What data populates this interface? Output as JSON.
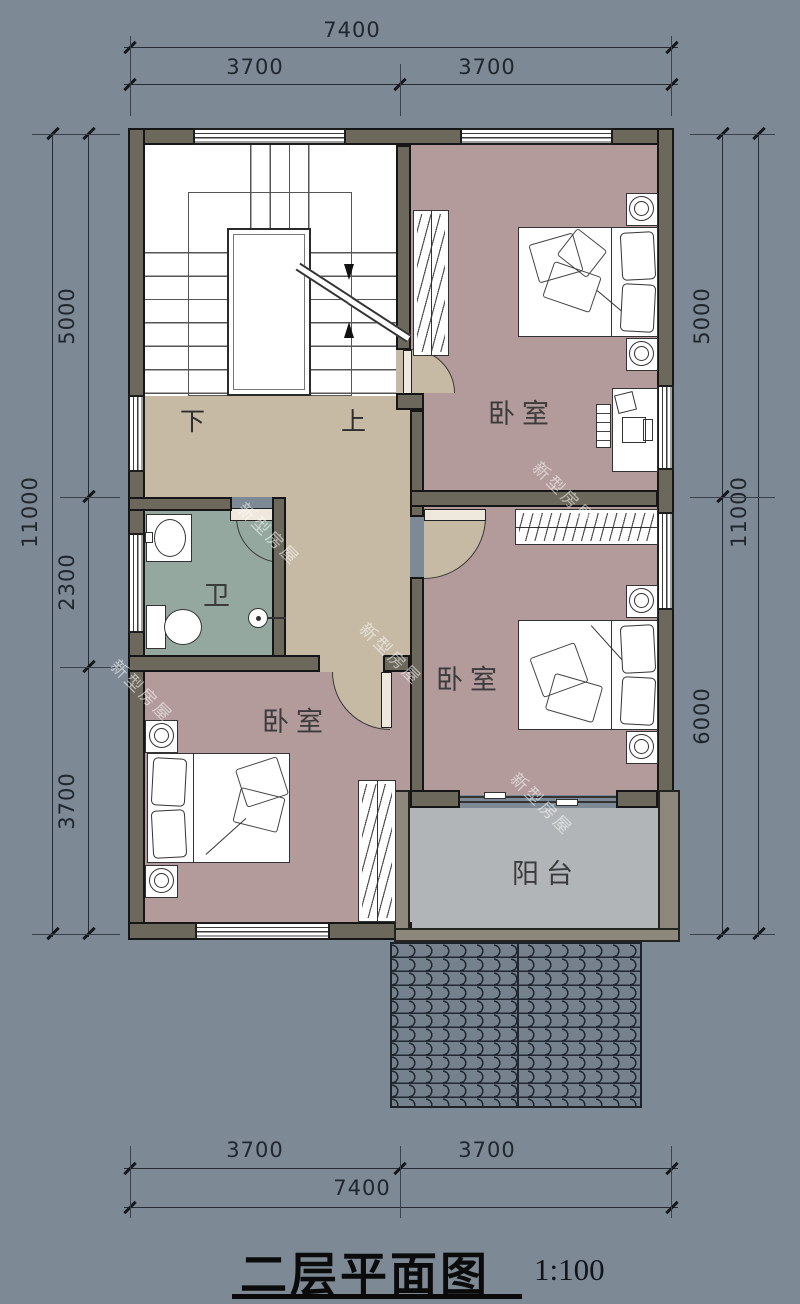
{
  "title": {
    "text": "二层平面图",
    "scale_label": "1:100"
  },
  "watermark_text": "新型房屋",
  "rooms": {
    "bedroom_top_right": "卧室",
    "bedroom_middle_right": "卧室",
    "bedroom_bottom_left": "卧室",
    "bathroom": "卫",
    "balcony": "阳台"
  },
  "stairs": {
    "down_label": "下",
    "up_label": "上"
  },
  "dimensions": {
    "top": {
      "total": "7400",
      "segments": [
        "3700",
        "3700"
      ]
    },
    "bottom": {
      "total": "7400",
      "segments": [
        "3700",
        "3700"
      ]
    },
    "left": {
      "total": "11000",
      "segments": [
        "5000",
        "2300",
        "3700"
      ]
    },
    "right": {
      "total": "11000",
      "segments": [
        "5000",
        "6000"
      ]
    }
  },
  "colors": {
    "background": "#7d8a95",
    "wall": "#6c685b",
    "hall_floor": "#c6baa5",
    "bedroom_floor": "#b29b9a",
    "bathroom_floor": "#95a8a0",
    "balcony_floor": "#b2b5b7",
    "roof": "#75818d"
  }
}
